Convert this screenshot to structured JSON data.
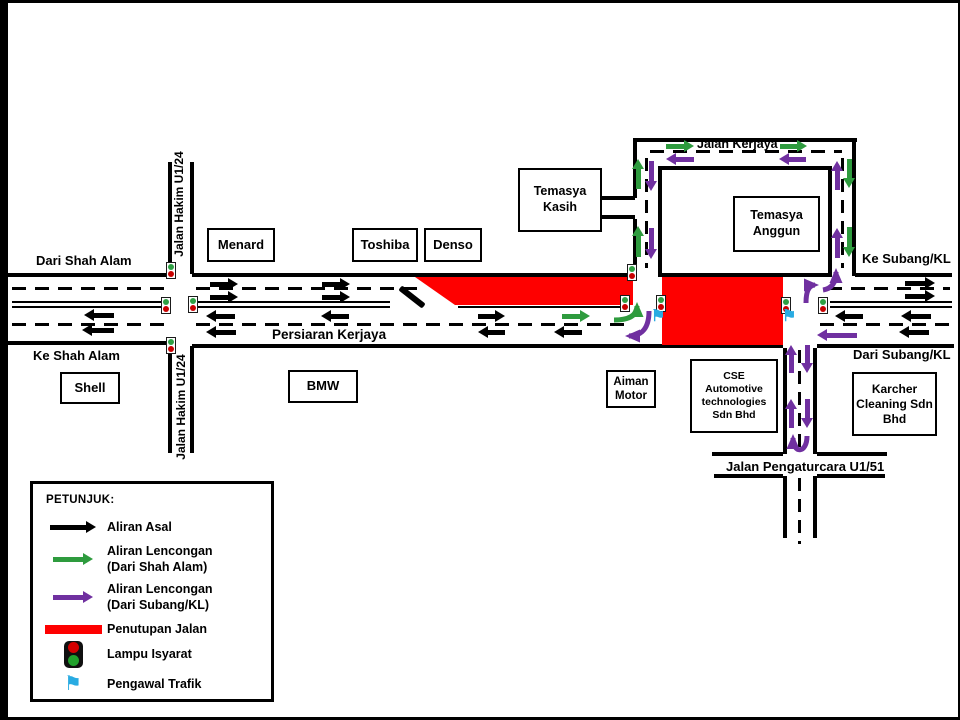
{
  "colors": {
    "flow_original": "#000000",
    "flow_from_shah_alam": "#2E9B3E",
    "flow_from_subang": "#7030A0",
    "closure": "#FE0000",
    "controller_blue": "#29ABE2",
    "light_red": "#C80000",
    "light_green": "#2EA043"
  },
  "roads": {
    "persiaran_kerjaya": "Persiaran Kerjaya",
    "jalan_hakim": "Jalan Hakim U1/24",
    "jalan_kerjaya": "Jalan Kerjaya",
    "jalan_pengaturcara": "Jalan Pengaturcara U1/51"
  },
  "directions": {
    "dari_shah_alam": "Dari Shah Alam",
    "ke_shah_alam": "Ke Shah Alam",
    "ke_subang": "Ke Subang/KL",
    "dari_subang": "Dari Subang/KL"
  },
  "places": {
    "menard": "Menard",
    "toshiba": "Toshiba",
    "denso": "Denso",
    "temasya_kasih": "Temasya Kasih",
    "temasya_anggun": "Temasya Anggun",
    "shell": "Shell",
    "bmw": "BMW",
    "aiman_motor": "Aiman Motor",
    "cse": "CSE Automotive technologies Sdn Bhd",
    "karcher": "Karcher Cleaning Sdn Bhd"
  },
  "legend": {
    "title": "PETUNJUK:",
    "items": [
      {
        "icon": "black-arrow",
        "line1": "Aliran Asal",
        "line2": ""
      },
      {
        "icon": "green-arrow",
        "line1": "Aliran Lencongan",
        "line2": "(Dari Shah Alam)"
      },
      {
        "icon": "purple-arrow",
        "line1": "Aliran Lencongan",
        "line2": "(Dari Subang/KL)"
      },
      {
        "icon": "red-bar",
        "line1": "Penutupan Jalan",
        "line2": ""
      },
      {
        "icon": "traffic-light",
        "line1": "Lampu Isyarat",
        "line2": ""
      },
      {
        "icon": "flag",
        "line1": "Pengawal Trafik",
        "line2": ""
      }
    ]
  }
}
